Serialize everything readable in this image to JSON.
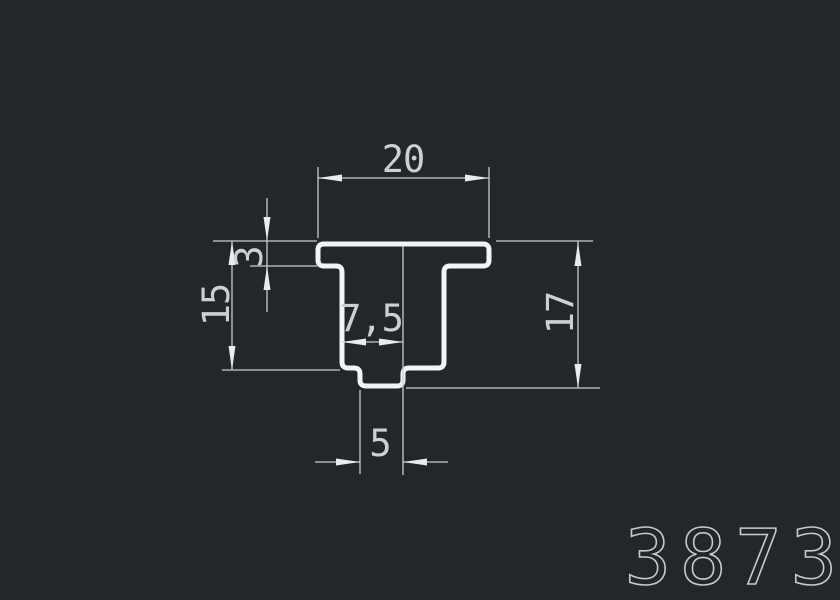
{
  "drawing_number": "3873",
  "dimensions": {
    "top_width": "20",
    "flange_thickness": "3",
    "left_height": "15",
    "inner_width": "7,5",
    "right_height": "17",
    "bottom_width": "5"
  },
  "colors": {
    "background": "#23272b",
    "profile_stroke": "#f3f4f5",
    "dimension_line": "#c7cbce",
    "arrow_fill": "#e9ebec",
    "dimension_text": "#ccd0d3",
    "drawing_number_stroke": "#c6cacd"
  }
}
